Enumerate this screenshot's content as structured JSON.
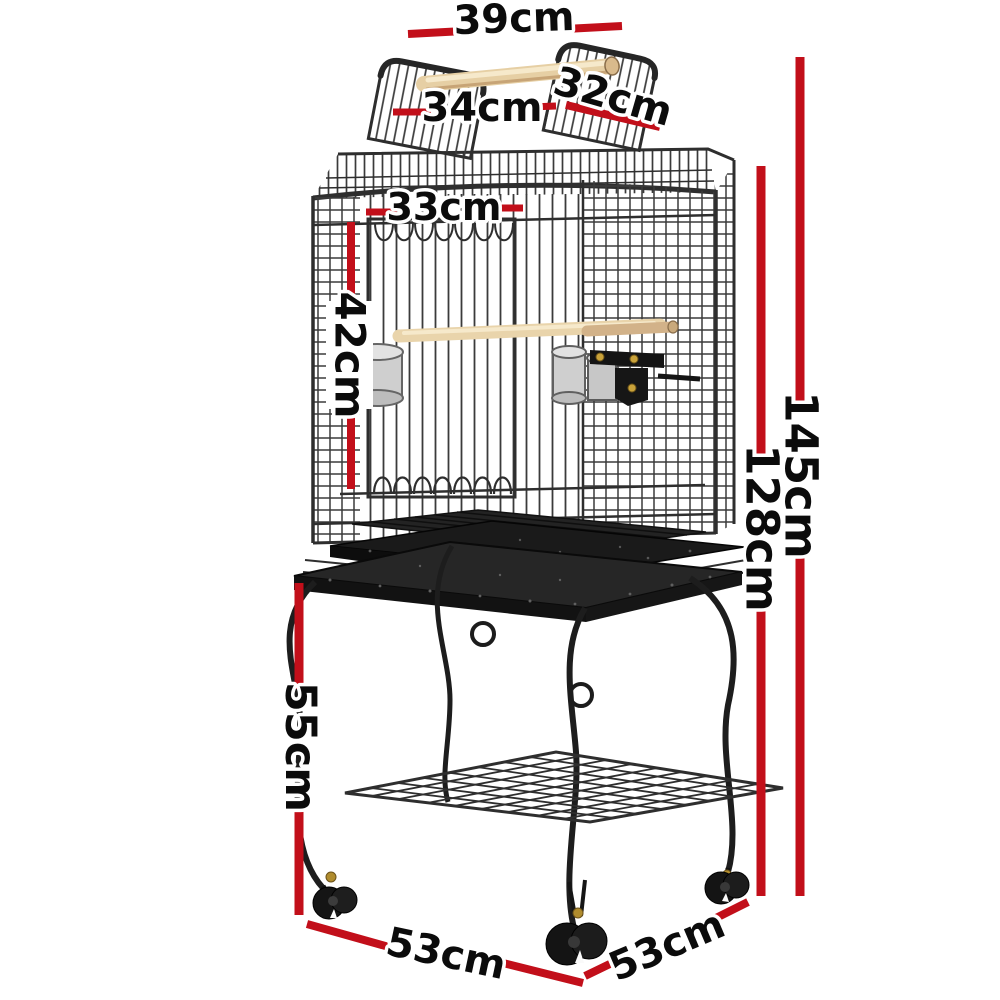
{
  "diagram": {
    "type": "product-dimension-diagram",
    "subject": "Open play-top bird cage on castor wheel stand",
    "background_color": "#ffffff",
    "accent_color": "#c20f1a",
    "measurements": {
      "play_top_width": "39cm",
      "top_opening_width": "34cm",
      "top_opening_depth": "32cm",
      "cage_front_width": "33cm",
      "upper_cage_height": "42cm",
      "total_height": "145cm",
      "cage_height": "128cm",
      "stand_height": "55cm",
      "base_width": "53cm",
      "base_depth": "53cm"
    },
    "illustration_parts": [
      "open-top panels",
      "wooden perch handle",
      "wire cage body",
      "front door",
      "stainless steel feeding bowls",
      "interior wooden perch",
      "slide-out tray",
      "stand platform",
      "scroll legs",
      "wire storage shelf",
      "castor wheels"
    ]
  }
}
